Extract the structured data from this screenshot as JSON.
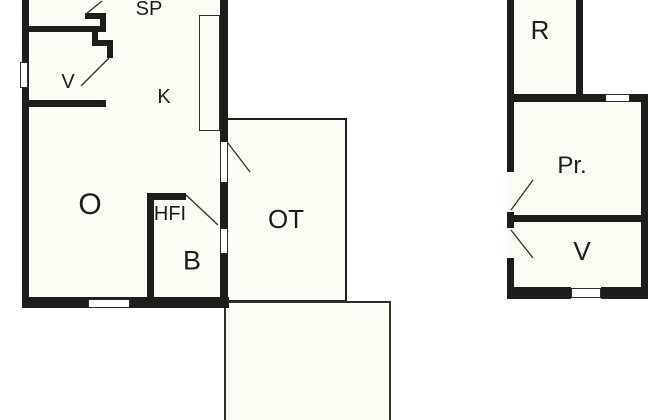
{
  "floorplan": {
    "type": "floor-plan",
    "rooms": {
      "sp": {
        "label": "SP"
      },
      "v_left": {
        "label": "V"
      },
      "k": {
        "label": "K"
      },
      "o": {
        "label": "O"
      },
      "hfi": {
        "label": "HFI"
      },
      "b": {
        "label": "B"
      },
      "ot": {
        "label": "OT"
      },
      "r": {
        "label": "R"
      },
      "pr": {
        "label": "Pr."
      },
      "v_right": {
        "label": "V"
      }
    },
    "colors": {
      "wall": "#1d1d1b",
      "room_fill": "#fcfcf4",
      "thin_line": "#2e2e2c",
      "background": "#ffffff"
    }
  }
}
